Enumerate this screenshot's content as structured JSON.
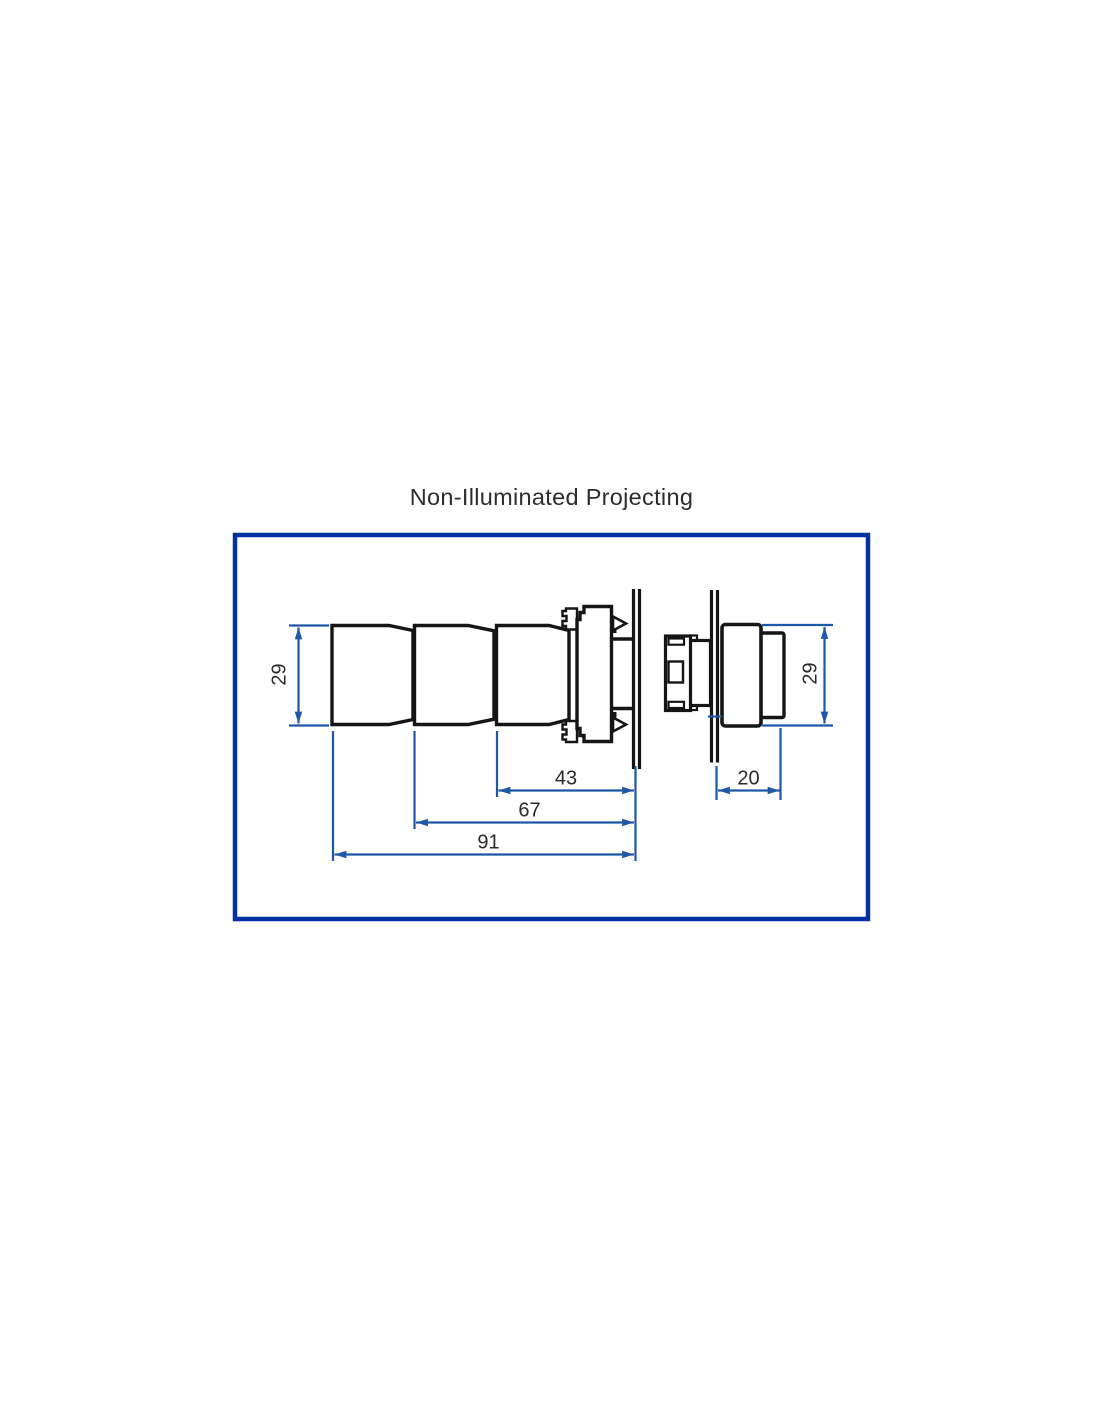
{
  "title": "Non-Illuminated Projecting",
  "colors": {
    "frame_border": "#0431a0",
    "drawing_outline": "#151515",
    "dimension_line": "#1d57a6",
    "dimension_text": "#2b2a29"
  },
  "left_view": {
    "height_mm": "29",
    "depth_total_mm": "91",
    "depth_mid_mm": "67",
    "depth_front_mm": "43"
  },
  "right_view": {
    "height_mm": "29",
    "projection_mm": "20"
  }
}
